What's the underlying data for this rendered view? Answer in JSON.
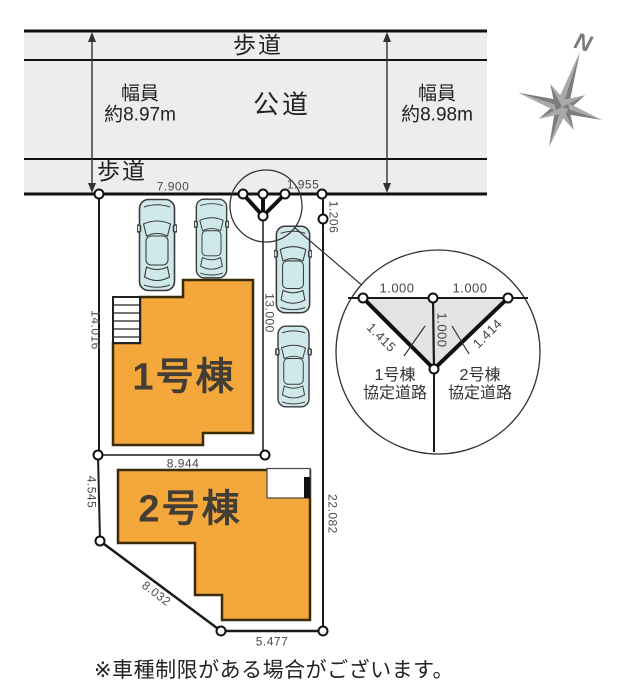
{
  "road": {
    "sidewalk_top": "歩道",
    "public_road": "公道",
    "sidewalk_bottom": "歩道",
    "width_left": {
      "l1": "幅員",
      "l2": "約8.97m"
    },
    "width_right": {
      "l1": "幅員",
      "l2": "約8.98m"
    }
  },
  "compass": {
    "north": "N"
  },
  "buildings": {
    "b1": "1号棟",
    "b2": "2号棟"
  },
  "dims": {
    "top_width": "7.900",
    "top_right_width": "1.955",
    "right_small": "1.206",
    "left_height": "14.016",
    "middle_height": "13.000",
    "mid_width": "8.944",
    "left_lower": "4.545",
    "right_height": "22.082",
    "diagonal": "8.032",
    "bottom_width": "5.477"
  },
  "detail": {
    "seg_left": "1.000",
    "seg_right": "1.000",
    "seg_vertical": "1.000",
    "diag_left": "1.415",
    "diag_right": "1.414",
    "road1": {
      "l1": "1号棟",
      "l2": "協定道路"
    },
    "road2": {
      "l1": "2号棟",
      "l2": "協定道路"
    }
  },
  "caption": "※車種制限がある場合がございます。",
  "colors": {
    "building_fill": "#F4A73B",
    "building_stroke": "#3B2B05",
    "road_fill": "#EDEDEB",
    "car_fill": "#CFE8EA",
    "detail_shade": "#E3E3E1",
    "compass_gray": "#8a8a8a"
  }
}
